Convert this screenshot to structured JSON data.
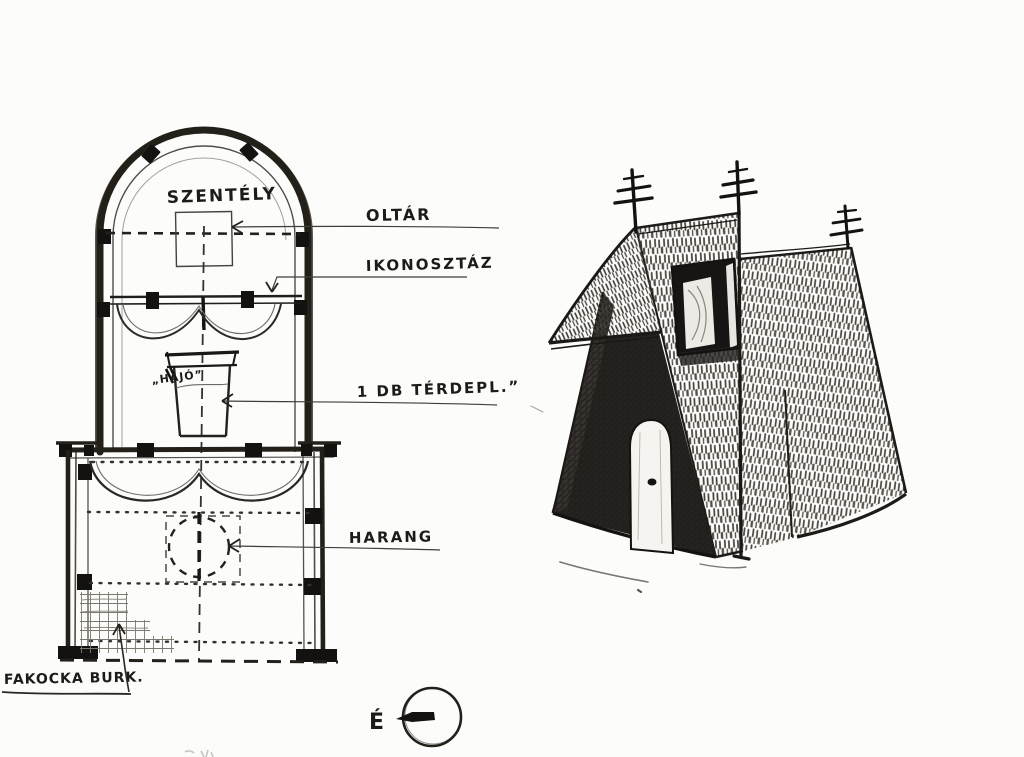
{
  "colors": {
    "ink": "#1d1b19",
    "paper": "#fcfcfa",
    "construction_line": "#55524d"
  },
  "floor_plan": {
    "sanctuary_label": "SZENTÉLY",
    "nave_label": "„HAJÓ”",
    "callouts": {
      "altar": "OLTÁR",
      "iconostasis": "IKONOSZTÁZ",
      "kneeler": "1 DB TÉRDEPL.”",
      "bell": "HARANG",
      "wood_block_paving": "FAKOCKA BURK."
    }
  },
  "compass": {
    "north": "É"
  }
}
